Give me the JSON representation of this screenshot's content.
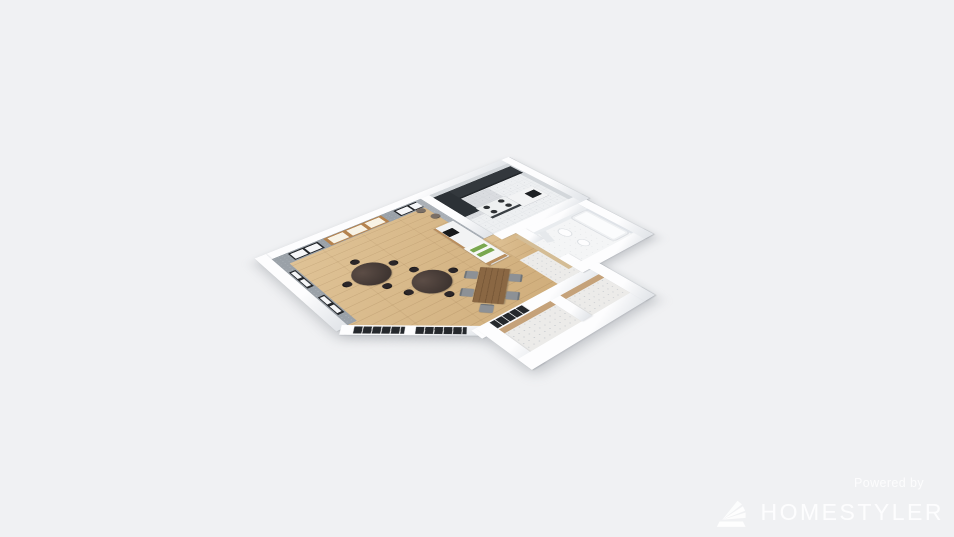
{
  "scene": {
    "render_type": "3d-floor-plan-render",
    "background": "#f0f1f3"
  },
  "watermark": {
    "powered_by": "Powered by",
    "brand": "HOMESTYLER",
    "logo": "homestyler-fan-icon",
    "text_color": "#ffffff"
  },
  "rooms": {
    "dining_area": {
      "floor": "light-wood-plank",
      "walls": "gray-concrete",
      "furniture": [
        "round-dining-table",
        "round-dining-table",
        "bentwood-chairs",
        "rectangular-wood-table",
        "gray-upholstered-chairs",
        "service-counter",
        "coffee-machine",
        "display-case"
      ]
    },
    "kitchen": {
      "floor": "white-tile",
      "furniture": [
        "l-shaped-dark-counter",
        "tall-dark-cabinet",
        "gas-stove-4-burners",
        "white-appliance-cabinet"
      ]
    },
    "bathroom": {
      "floor": "white",
      "furniture": [
        "bathtub",
        "toilet",
        "sink",
        "mirror-panel"
      ]
    },
    "closets": {
      "count": 2,
      "floor": "speckled-white",
      "walls": "tan"
    },
    "hallway": {
      "floor": "wood-to-speckle"
    }
  },
  "openings": [
    "north-window-left",
    "north-sliding-wood-door",
    "north-window-right",
    "west-window-upper",
    "west-window-lower",
    "chamfer-glazing",
    "south-window"
  ],
  "colors": {
    "background": "#f0f1f3",
    "wallTop": "#fdfdfe",
    "wallShade": "#e3e6ea",
    "concrete": "#9aa1a8",
    "woodFloor": "#d9ba8d",
    "woodDoor": "#b5834e",
    "darkFrame": "#23262a",
    "windowPane": "#f5f6f8",
    "tileFloor": "#edeff1",
    "counterDark": "#33383d",
    "cabinetDark": "#2c3136",
    "stoveTop": "#eef0f1",
    "burner": "#2e3134",
    "whiteCabinet": "#f2f3f4",
    "tableDark": "#3f3531",
    "chairBlack": "#2b2628",
    "tableWood": "#8a6743",
    "chairGray": "#8d9196",
    "chairTaupe": "#7a6f66",
    "tanWall": "#c5a27a",
    "bathFloor": "#f4f5f6",
    "mirror": "#dfe3e8",
    "tub": "#fbfcfd",
    "displayGreen": "#7aa84f",
    "counterWoodBase": "#b98e5e"
  }
}
